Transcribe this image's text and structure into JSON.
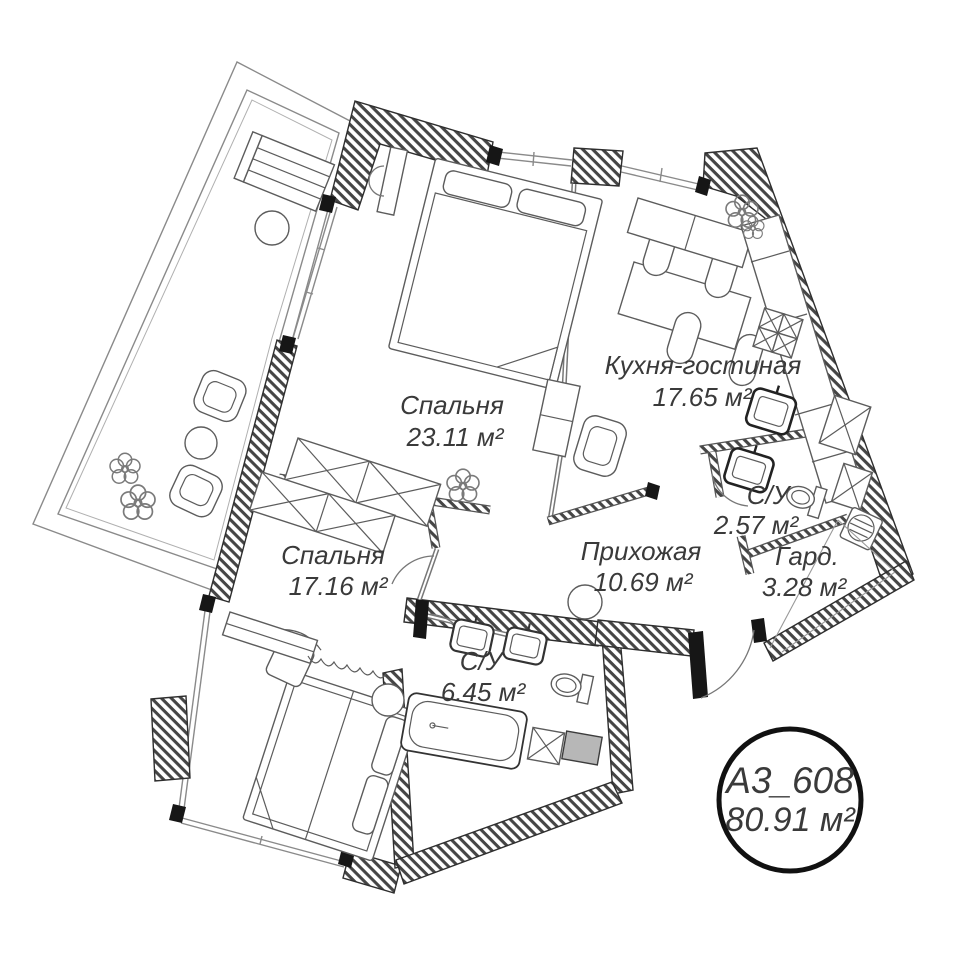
{
  "unit_badge": {
    "id": "A3_608",
    "area": "80.91 м²"
  },
  "rooms": [
    {
      "key": "bedroom-1",
      "name": "Спальня",
      "area": "23.11 м²"
    },
    {
      "key": "kitchen-living",
      "name": "Кухня-гостиная",
      "area": "17.65 м²"
    },
    {
      "key": "bathroom-small",
      "name": "С/У",
      "area": "2.57 м²"
    },
    {
      "key": "wardrobe",
      "name": "Гард.",
      "area": "3.28 м²"
    },
    {
      "key": "hallway",
      "name": "Прихожая",
      "area": "10.69 м²"
    },
    {
      "key": "bedroom-2",
      "name": "Спальня",
      "area": "17.16 м²"
    },
    {
      "key": "bathroom-large",
      "name": "С/У",
      "area": "6.45 м²"
    }
  ],
  "colors": {
    "wall_hatch": "#4a4a4a",
    "outline": "#2e2e2e",
    "thin_line": "#8a8a8a",
    "text": "#3a3a3a",
    "appliance_gray": "#b7b7b7",
    "background": "#ffffff"
  }
}
